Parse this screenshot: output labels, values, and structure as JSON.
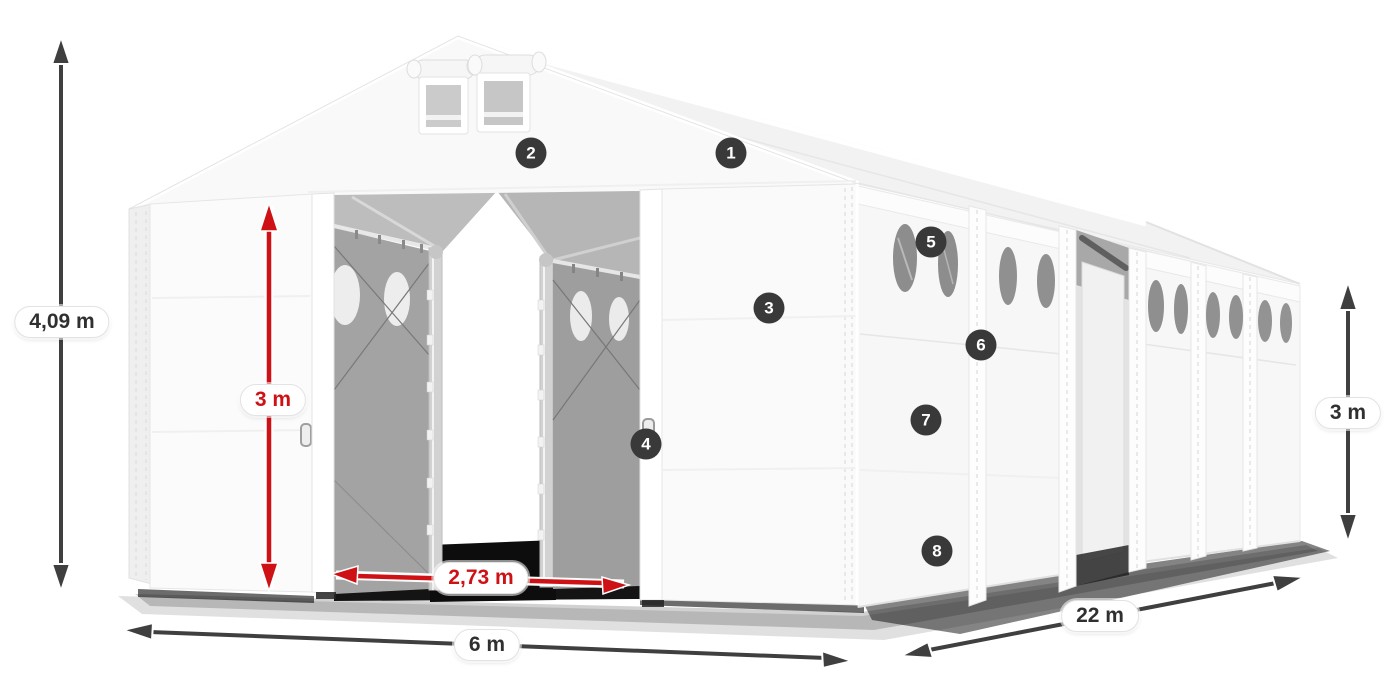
{
  "annotations": {
    "total_height": {
      "label": "4,09 m",
      "color": "dark"
    },
    "door_height": {
      "label": "3 m",
      "color": "red"
    },
    "door_width": {
      "label": "2,73 m",
      "color": "red"
    },
    "front_width": {
      "label": "6 m",
      "color": "dark"
    },
    "side_length": {
      "label": "22 m",
      "color": "dark"
    },
    "side_height": {
      "label": "3 m",
      "color": "dark"
    }
  },
  "markers": [
    {
      "number": "1"
    },
    {
      "number": "2"
    },
    {
      "number": "3"
    },
    {
      "number": "4"
    },
    {
      "number": "5"
    },
    {
      "number": "6"
    },
    {
      "number": "7"
    },
    {
      "number": "8"
    }
  ],
  "colors": {
    "dimension_dark": "#3f3f3f",
    "dimension_red": "#ce1115",
    "marker_background": "#393939",
    "marker_text": "#ffffff",
    "label_background": "#ffffff",
    "label_text_dark": "#303030",
    "canvas_background": "#ffffff"
  }
}
